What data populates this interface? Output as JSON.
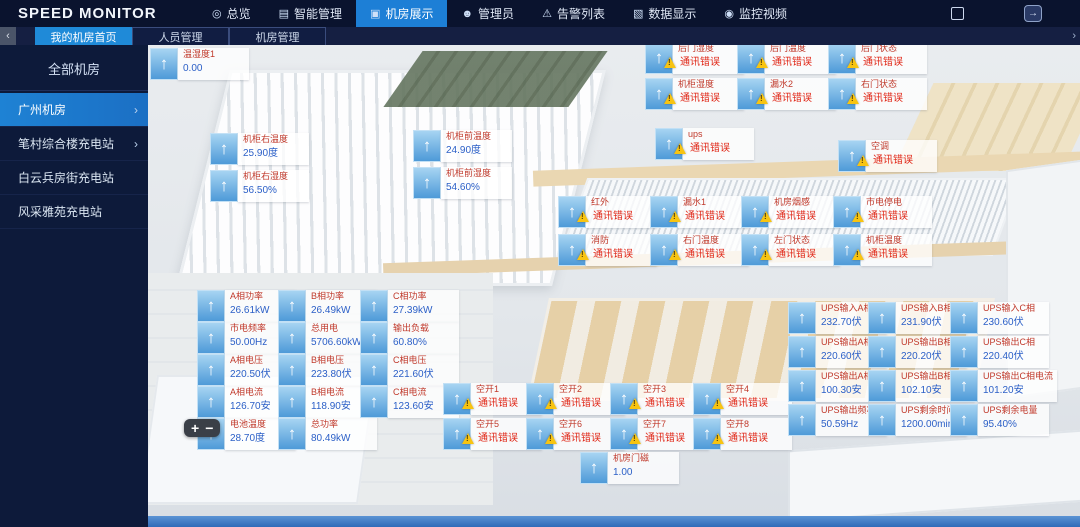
{
  "app": {
    "title": "SPEED MONITOR"
  },
  "icons": {
    "exit_arrow": "→",
    "collapse": "‹",
    "overflow": "›",
    "chevron": "›",
    "arrow_up": "↑",
    "zoom_in": "+",
    "zoom_out": "−"
  },
  "colors": {
    "accent_blue": "#1d7fd6",
    "tab_active": "#1f8ad8",
    "alarm_red": "#e02616",
    "name_red": "#c0392b",
    "value_blue": "#2b5fc7",
    "warning_yellow": "#f8c411",
    "topbar_bg": "#0a132e",
    "sidebar_bg": "#0d1a3a"
  },
  "topnav": {
    "items": [
      {
        "label": "总览",
        "icon": "◎",
        "active": false
      },
      {
        "label": "智能管理",
        "icon": "▤",
        "active": false
      },
      {
        "label": "机房展示",
        "icon": "▣",
        "active": true
      },
      {
        "label": "管理员",
        "icon": "☻",
        "active": false
      },
      {
        "label": "告警列表",
        "icon": "⚠",
        "active": false
      },
      {
        "label": "数据显示",
        "icon": "▧",
        "active": false
      },
      {
        "label": "监控视频",
        "icon": "◉",
        "active": false
      }
    ]
  },
  "tabs": {
    "items": [
      {
        "label": "我的机房首页",
        "active": true
      },
      {
        "label": "人员管理",
        "active": false
      },
      {
        "label": "机房管理",
        "active": false
      }
    ]
  },
  "sidebar": {
    "header": "全部机房",
    "items": [
      {
        "label": "广州机房",
        "active": true,
        "chevron": true
      },
      {
        "label": "笔村综合楼充电站",
        "active": false,
        "chevron": true
      },
      {
        "label": "白云兵房街充电站",
        "active": false,
        "chevron": false
      },
      {
        "label": "风采雅苑充电站",
        "active": false,
        "chevron": false
      }
    ]
  },
  "sensors": [
    {
      "name": "温湿度1",
      "value": "0.00",
      "error": false,
      "x": 2,
      "y": 3
    },
    {
      "name": "机柜右温度",
      "value": "25.90度",
      "error": false,
      "x": 62,
      "y": 88
    },
    {
      "name": "机柜右湿度",
      "value": "56.50%",
      "error": false,
      "x": 62,
      "y": 125
    },
    {
      "name": "机柜前温度",
      "value": "24.90度",
      "error": false,
      "x": 265,
      "y": 85
    },
    {
      "name": "机柜前湿度",
      "value": "54.60%",
      "error": false,
      "x": 265,
      "y": 122
    },
    {
      "name": "后门湿度",
      "value": "通讯错误",
      "error": true,
      "x": 497,
      "y": -3
    },
    {
      "name": "后门温度",
      "value": "通讯错误",
      "error": true,
      "x": 589,
      "y": -3
    },
    {
      "name": "后门状态",
      "value": "通讯错误",
      "error": true,
      "x": 680,
      "y": -3
    },
    {
      "name": "机柜湿度",
      "value": "通讯错误",
      "error": true,
      "x": 497,
      "y": 33
    },
    {
      "name": "漏水2",
      "value": "通讯错误",
      "error": true,
      "x": 589,
      "y": 33
    },
    {
      "name": "右门状态",
      "value": "通讯错误",
      "error": true,
      "x": 680,
      "y": 33
    },
    {
      "name": "ups",
      "value": "通讯错误",
      "error": true,
      "x": 507,
      "y": 83
    },
    {
      "name": "空调",
      "value": "通讯错误",
      "error": true,
      "x": 690,
      "y": 95
    },
    {
      "name": "红外",
      "value": "通讯错误",
      "error": true,
      "x": 410,
      "y": 151
    },
    {
      "name": "漏水1",
      "value": "通讯错误",
      "error": true,
      "x": 502,
      "y": 151
    },
    {
      "name": "机房烟感",
      "value": "通讯错误",
      "error": true,
      "x": 593,
      "y": 151
    },
    {
      "name": "市电停电",
      "value": "通讯错误",
      "error": true,
      "x": 685,
      "y": 151
    },
    {
      "name": "消防",
      "value": "通讯错误",
      "error": true,
      "x": 410,
      "y": 189
    },
    {
      "name": "右门温度",
      "value": "通讯错误",
      "error": true,
      "x": 502,
      "y": 189
    },
    {
      "name": "左门状态",
      "value": "通讯错误",
      "error": true,
      "x": 593,
      "y": 189
    },
    {
      "name": "机柜温度",
      "value": "通讯错误",
      "error": true,
      "x": 685,
      "y": 189
    },
    {
      "name": "A相功率",
      "value": "26.61kW",
      "error": false,
      "x": 49,
      "y": 245
    },
    {
      "name": "市电频率",
      "value": "50.00Hz",
      "error": false,
      "x": 49,
      "y": 277
    },
    {
      "name": "A相电压",
      "value": "220.50伏",
      "error": false,
      "x": 49,
      "y": 309
    },
    {
      "name": "A相电流",
      "value": "126.70安",
      "error": false,
      "x": 49,
      "y": 341
    },
    {
      "name": "电池温度",
      "value": "28.70度",
      "error": false,
      "x": 49,
      "y": 373
    },
    {
      "name": "B相功率",
      "value": "26.49kW",
      "error": false,
      "x": 130,
      "y": 245
    },
    {
      "name": "总用电",
      "value": "5706.60kWh",
      "error": false,
      "x": 130,
      "y": 277
    },
    {
      "name": "B相电压",
      "value": "223.80伏",
      "error": false,
      "x": 130,
      "y": 309
    },
    {
      "name": "B相电流",
      "value": "118.90安",
      "error": false,
      "x": 130,
      "y": 341
    },
    {
      "name": "总功率",
      "value": "80.49kW",
      "error": false,
      "x": 130,
      "y": 373
    },
    {
      "name": "C相功率",
      "value": "27.39kW",
      "error": false,
      "x": 212,
      "y": 245
    },
    {
      "name": "输出负载",
      "value": "60.80%",
      "error": false,
      "x": 212,
      "y": 277
    },
    {
      "name": "C相电压",
      "value": "221.60伏",
      "error": false,
      "x": 212,
      "y": 309
    },
    {
      "name": "C相电流",
      "value": "123.60安",
      "error": false,
      "x": 212,
      "y": 341
    },
    {
      "name": "空开1",
      "value": "通讯错误",
      "error": true,
      "x": 295,
      "y": 338
    },
    {
      "name": "空开2",
      "value": "通讯错误",
      "error": true,
      "x": 378,
      "y": 338
    },
    {
      "name": "空开3",
      "value": "通讯错误",
      "error": true,
      "x": 462,
      "y": 338
    },
    {
      "name": "空开4",
      "value": "通讯错误",
      "error": true,
      "x": 545,
      "y": 338
    },
    {
      "name": "空开5",
      "value": "通讯错误",
      "error": true,
      "x": 295,
      "y": 373
    },
    {
      "name": "空开6",
      "value": "通讯错误",
      "error": true,
      "x": 378,
      "y": 373
    },
    {
      "name": "空开7",
      "value": "通讯错误",
      "error": true,
      "x": 462,
      "y": 373
    },
    {
      "name": "空开8",
      "value": "通讯错误",
      "error": true,
      "x": 545,
      "y": 373
    },
    {
      "name": "机房门磁",
      "value": "1.00",
      "error": false,
      "x": 432,
      "y": 407
    },
    {
      "name": "UPS输入A相",
      "value": "232.70伏",
      "error": false,
      "x": 640,
      "y": 257
    },
    {
      "name": "UPS输出A相",
      "value": "220.60伏",
      "error": false,
      "x": 640,
      "y": 291
    },
    {
      "name": "UPS输出A相电流",
      "value": "100.30安",
      "error": false,
      "x": 640,
      "y": 325
    },
    {
      "name": "UPS输出频率",
      "value": "50.59Hz",
      "error": false,
      "x": 640,
      "y": 359
    },
    {
      "name": "UPS输入B相",
      "value": "231.90伏",
      "error": false,
      "x": 720,
      "y": 257
    },
    {
      "name": "UPS输出B相",
      "value": "220.20伏",
      "error": false,
      "x": 720,
      "y": 291
    },
    {
      "name": "UPS输出B相电流",
      "value": "102.10安",
      "error": false,
      "x": 720,
      "y": 325
    },
    {
      "name": "UPS剩余时间",
      "value": "1200.00min",
      "error": false,
      "x": 720,
      "y": 359
    },
    {
      "name": "UPS输入C相",
      "value": "230.60伏",
      "error": false,
      "x": 802,
      "y": 257
    },
    {
      "name": "UPS输出C相",
      "value": "220.40伏",
      "error": false,
      "x": 802,
      "y": 291
    },
    {
      "name": "UPS输出C相电流",
      "value": "101.20安",
      "error": false,
      "x": 802,
      "y": 325
    },
    {
      "name": "UPS剩余电量",
      "value": "95.40%",
      "error": false,
      "x": 802,
      "y": 359
    }
  ]
}
